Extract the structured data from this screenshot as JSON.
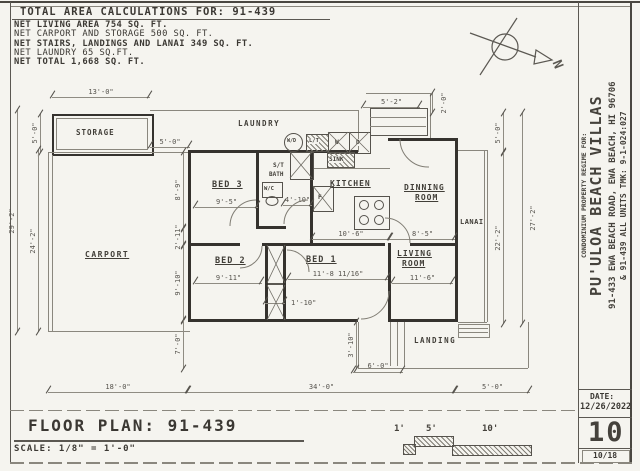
{
  "colors": {
    "paper": "#f5f4ef",
    "ink": "#3b3833",
    "line_gray": "#8a877e"
  },
  "area_calc": {
    "title": "TOTAL AREA CALCULATIONS FOR: 91-439",
    "rows": [
      "NET LIVING AREA 754 SQ. FT.",
      "NET CARPORT AND STORAGE 500 SQ. FT.",
      "NET STAIRS, LANDINGS AND LANAI 349 SQ. FT.",
      "NET LAUNDRY 65 SQ.FT.",
      "NET TOTAL 1,668 SQ. FT."
    ]
  },
  "plan": {
    "north": "N",
    "rooms": {
      "storage": "STORAGE",
      "laundry": "LAUNDRY",
      "carport": "CARPORT",
      "bed3": "BED 3",
      "bed2": "BED 2",
      "bed1": "BED 1",
      "kitchen": "KITCHEN",
      "dining1": "DINNING",
      "dining2": "ROOM",
      "living1": "LIVING",
      "living2": "ROOM",
      "lanai": "LANAI",
      "landing": "LANDING"
    },
    "fixtures": {
      "wd": "W/D",
      "lt": "L/T",
      "sink": "SINK",
      "washer": "W",
      "dryer": "D",
      "fridge": "F",
      "wc": "W/C",
      "bath1": "S/T",
      "bath2": "BATH"
    },
    "dims": [
      {
        "label": "13'-0\""
      },
      {
        "label": "5'-0\""
      },
      {
        "label": "5'-0\""
      },
      {
        "label": "29'-2\""
      },
      {
        "label": "24'-2\""
      },
      {
        "label": "8'-9\""
      },
      {
        "label": "2'-11\""
      },
      {
        "label": "9'-10\""
      },
      {
        "label": "7'-0\""
      },
      {
        "label": "5'-2\""
      },
      {
        "label": "2'-0\""
      },
      {
        "label": "5'-0\""
      },
      {
        "label": "22'-2\""
      },
      {
        "label": "27'-2\""
      },
      {
        "label": "9'-5\""
      },
      {
        "label": "4'-10\""
      },
      {
        "label": "10'-6\""
      },
      {
        "label": "8'-5\""
      },
      {
        "label": "9'-11\""
      },
      {
        "label": "11'-8 11/16\""
      },
      {
        "label": "11'-6\""
      },
      {
        "label": "1'-10\""
      },
      {
        "label": "3'-10\""
      },
      {
        "label": "6'-0\""
      },
      {
        "label": "18'-0\""
      },
      {
        "label": "34'-0\""
      },
      {
        "label": "5'-0\""
      }
    ]
  },
  "footer": {
    "title": "FLOOR PLAN: 91-439",
    "scale": "SCALE: 1/8\" = 1'-0\"",
    "scalebar": [
      "1'",
      "5'",
      "10'"
    ]
  },
  "title_block": {
    "line1": "CONDOMINIUM PROPERTY REGIME FOR:",
    "line2": "PU'ULOA BEACH VILLAS",
    "line3": "91-433 EWA BEACH ROAD, EWA BEACH, HI 96706",
    "line4": "& 91-439 ALL UNITS  TMK: 9-1-024:027",
    "date_label": "DATE:",
    "date": "12/26/2022",
    "page": "10",
    "sheet_index": "10/18"
  }
}
